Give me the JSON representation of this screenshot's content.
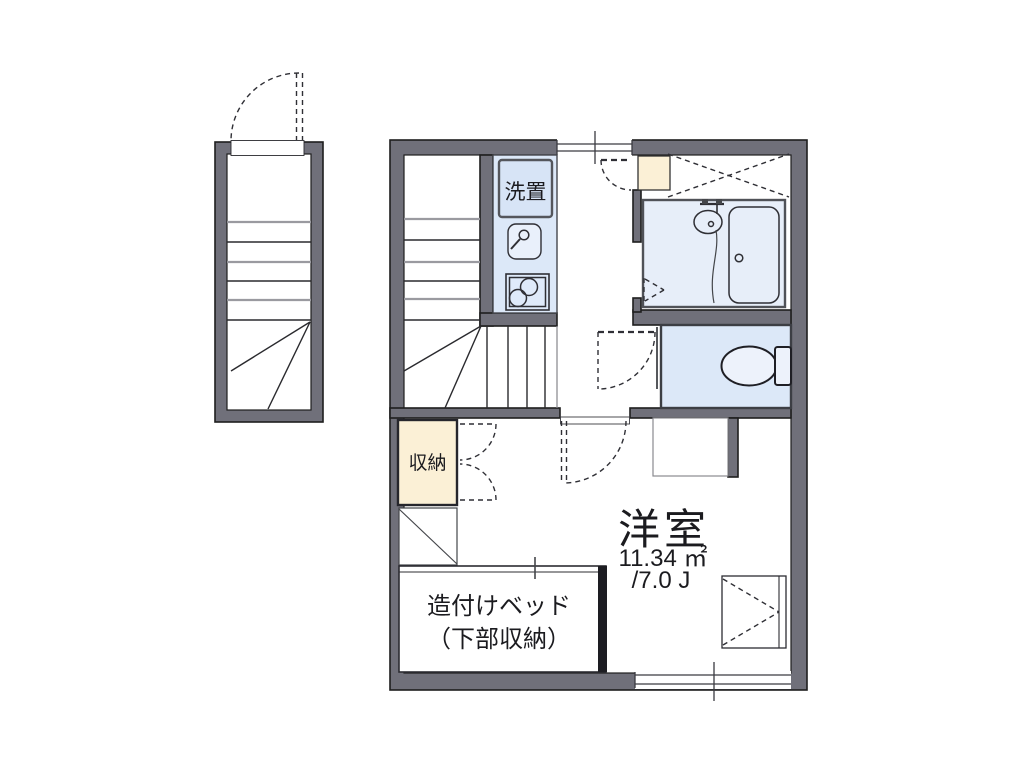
{
  "title": "apartment floor plan",
  "colors": {
    "wall": "#70707a",
    "line": "#1e1e1e",
    "water": "#dce8f8",
    "bath": "#e7eef9",
    "laundry_box": "#d7e4f6",
    "cream": "#fbf0d6",
    "fixture_fill": "#edf2fb"
  },
  "labels": {
    "laundry": "洗置",
    "storage": "収納",
    "bed_line1": "造付けベッド",
    "bed_line2": "（下部収納）"
  },
  "room": {
    "name": "洋室",
    "area_sqm": "11.34 ㎡",
    "area_jo": "/7.0 J"
  },
  "rooms": [
    {
      "name": "洋室",
      "area_sqm": "11.34 ㎡",
      "area_jo": "/7.0 J"
    },
    {
      "name": "収納"
    },
    {
      "name": "洗置"
    },
    {
      "name": "造付けベッド（下部収納）"
    }
  ],
  "fixtures": [
    "outdoor-staircase",
    "indoor-staircase",
    "entrance-door",
    "entrance-mat",
    "kitchen-counter",
    "washer-space",
    "kitchen-sink",
    "two-burner-stove",
    "unit-bath",
    "bathtub",
    "wash-basin",
    "shower-hose",
    "bath-folding-door",
    "toilet",
    "toilet-tank",
    "toilet-door",
    "room-door",
    "closet-double-door",
    "built-in-bed",
    "window-top",
    "window-bottom",
    "loft-cross-mark",
    "counter-shelf"
  ]
}
